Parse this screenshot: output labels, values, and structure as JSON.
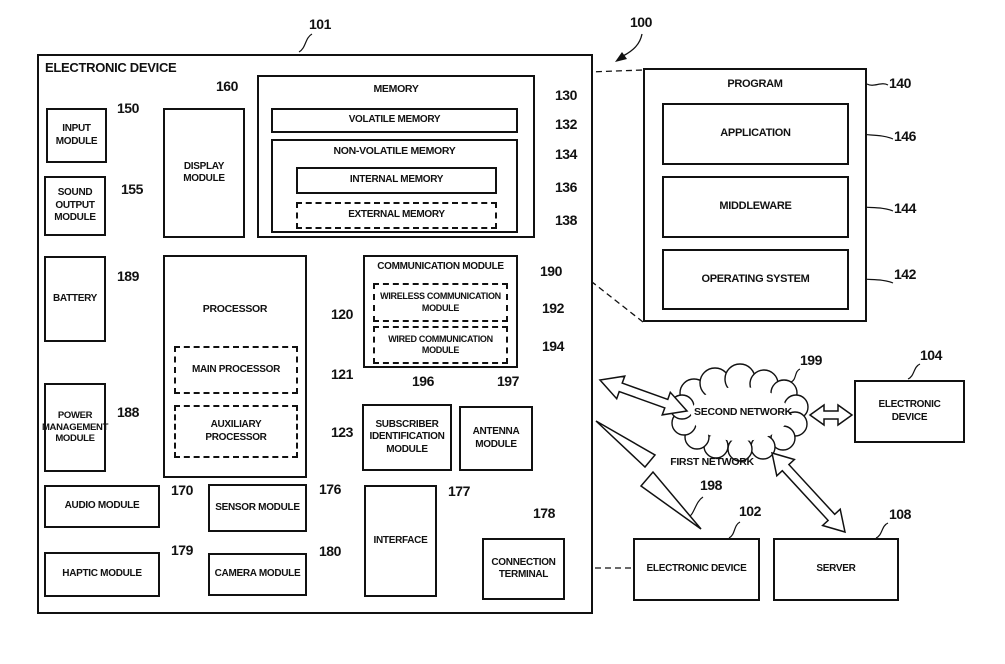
{
  "figure": {
    "ref": "100"
  },
  "device": {
    "title": "ELECTRONIC DEVICE",
    "ref": "101"
  },
  "blocks": {
    "input_module": {
      "label": "INPUT\nMODULE",
      "ref": "150"
    },
    "sound_output_module": {
      "label": "SOUND\nOUTPUT\nMODULE",
      "ref": "155"
    },
    "display_module": {
      "label": "DISPLAY\nMODULE",
      "ref": "160"
    },
    "memory": {
      "label": "MEMORY",
      "ref": "130"
    },
    "volatile_memory": {
      "label": "VOLATILE MEMORY",
      "ref": "132"
    },
    "non_volatile_memory": {
      "label": "NON-VOLATILE MEMORY",
      "ref": "134"
    },
    "internal_memory": {
      "label": "INTERNAL MEMORY",
      "ref": "136"
    },
    "external_memory": {
      "label": "EXTERNAL MEMORY",
      "ref": "138"
    },
    "battery": {
      "label": "BATTERY",
      "ref": "189"
    },
    "processor": {
      "label": "PROCESSOR",
      "ref": "120"
    },
    "main_processor": {
      "label": "MAIN PROCESSOR",
      "ref": "121"
    },
    "auxiliary_processor": {
      "label": "AUXILIARY\nPROCESSOR",
      "ref": "123"
    },
    "communication_module": {
      "label": "COMMUNICATION MODULE",
      "ref": "190"
    },
    "wireless_communication_module": {
      "label": "WIRELESS COMMUNICATION\nMODULE",
      "ref": "192"
    },
    "wired_communication_module": {
      "label": "WIRED COMMUNICATION\nMODULE",
      "ref": "194"
    },
    "power_management_module": {
      "label": "POWER\nMANAGEMENT\nMODULE",
      "ref": "188"
    },
    "subscriber_identification_module": {
      "label": "SUBSCRIBER\nIDENTIFICATION\nMODULE",
      "ref": "196"
    },
    "antenna_module": {
      "label": "ANTENNA\nMODULE",
      "ref": "197"
    },
    "audio_module": {
      "label": "AUDIO MODULE",
      "ref": "170"
    },
    "sensor_module": {
      "label": "SENSOR MODULE",
      "ref": "176"
    },
    "haptic_module": {
      "label": "HAPTIC MODULE",
      "ref": "179"
    },
    "camera_module": {
      "label": "CAMERA MODULE",
      "ref": "180"
    },
    "interface": {
      "label": "INTERFACE",
      "ref": "177"
    },
    "connection_terminal": {
      "label": "CONNECTION\nTERMINAL",
      "ref": "178"
    }
  },
  "program": {
    "title": "PROGRAM",
    "ref": "140",
    "application": {
      "label": "APPLICATION",
      "ref": "146"
    },
    "middleware": {
      "label": "MIDDLEWARE",
      "ref": "144"
    },
    "operating_system": {
      "label": "OPERATING SYSTEM",
      "ref": "142"
    }
  },
  "network": {
    "second_network": {
      "label": "SECOND NETWORK",
      "ref": "199"
    },
    "first_network": {
      "label": "FIRST NETWORK",
      "ref": "198"
    },
    "electronic_device_104": {
      "label": "ELECTRONIC\nDEVICE",
      "ref": "104"
    },
    "electronic_device_102": {
      "label": "ELECTRONIC DEVICE",
      "ref": "102"
    },
    "server": {
      "label": "SERVER",
      "ref": "108"
    }
  },
  "colors": {
    "line": "#111111",
    "background": "#ffffff"
  }
}
